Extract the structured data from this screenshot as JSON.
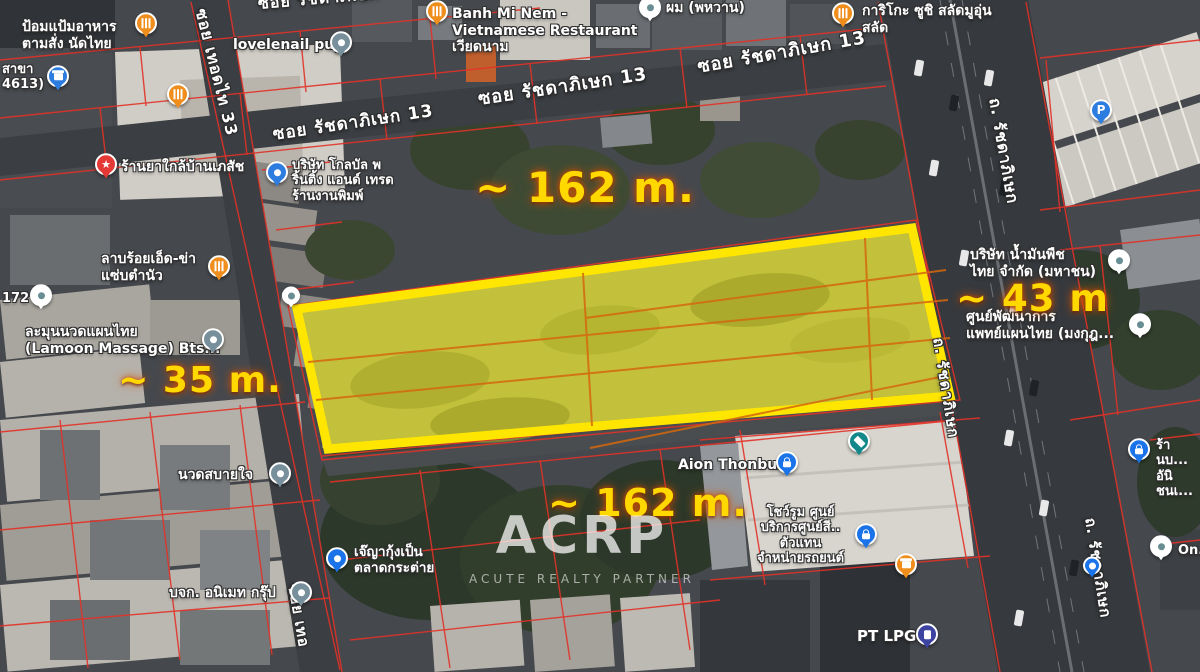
{
  "map": {
    "dimensions": {
      "top": "~ 162 m.",
      "bottom": "~ 162 m.",
      "left": "~ 35 m.",
      "right": "~ 43 m",
      "color": "#ffd800"
    },
    "watermark": {
      "logo": "ACRP",
      "tagline": "ACUTE REALTY PARTNER"
    },
    "streets": [
      {
        "id": "soi-ratchadaphisek-top-partial",
        "label": "ซอย รัชดาภิเษก"
      },
      {
        "id": "soi-ratchadaphisek-13-west",
        "label": "ซอย รัชดาภิเษก 13"
      },
      {
        "id": "soi-ratchadaphisek-13-mid",
        "label": "ซอย รัชดาภิเษก 13"
      },
      {
        "id": "soi-ratchadaphisek-13-east",
        "label": "ซอย รัชดาภิเษก 13"
      },
      {
        "id": "soi-thoet-thai-33",
        "label": "ซอย เทอดไท 33"
      },
      {
        "id": "soi-thoet-thai-bottom-partial",
        "label": "ซอย เทอ"
      },
      {
        "id": "thanon-ratchadaphisek-upper",
        "label": "ถ. รัชดาภิเษก"
      },
      {
        "id": "thanon-ratchadaphisek-mid",
        "label": "ถ. รัชดาภิเษก"
      },
      {
        "id": "thanon-ratchadaphisek-lower",
        "label": "ถ. รัชดาภิเษก"
      }
    ],
    "pois": [
      {
        "id": "pompam-restaurant",
        "label": "ป้อมแป้มอาหาร\nตามสั่ง นัดไทย"
      },
      {
        "id": "branch-4613",
        "label": "สาขา\n4613)"
      },
      {
        "id": "marker-172",
        "label": "172"
      },
      {
        "id": "pharmacy",
        "label": "ร้านยาใกล้บ้านเภสัช"
      },
      {
        "id": "global-printing",
        "label": "บริษัท โกลบัล พ\nริ้นติ้ง แอนด์ เทรด\nร้านงานพิมพ์"
      },
      {
        "id": "lovelenail",
        "label": "lovelenail puy"
      },
      {
        "id": "banh-mi-nem",
        "label": "Banh Mi Nem -\nVietnamese Restaurant\nเวียดนาม"
      },
      {
        "id": "hair-salon",
        "label": "ผม (พหวาน)"
      },
      {
        "id": "kariko-sushi",
        "label": "การิโกะ ซูชิ สลัดมูอุ่น\nสลัด"
      },
      {
        "id": "lab-roi-et",
        "label": "ลาบร้อยเอ็ด-ข่า\nแซ่บตำนัว"
      },
      {
        "id": "lamoon-massage",
        "label": "ละมุนนวดแผนไทย\n(Lamoon Massage) Bts..."
      },
      {
        "id": "nuat-sabai-jai",
        "label": "นวดสบายใจ"
      },
      {
        "id": "animate-group",
        "label": "บจก. อนิเมท กรุ๊ป"
      },
      {
        "id": "je-ya-kung",
        "label": "เจ๊ญากุ้งเป็น\nตลาดกระต่าย"
      },
      {
        "id": "aion-thonburi",
        "label": "Aion Thonburi"
      },
      {
        "id": "car-showroom",
        "label": "โชว์รูม ศูนย์\nบริการศูนย์สี..\nตัวแทน\nจำหน่ายรถยนต์"
      },
      {
        "id": "pt-lpg",
        "label": "PT LPG"
      },
      {
        "id": "thai-vegetable-oil",
        "label": "บริษัท น้ำมันพืช\nไทย จำกัด (มหาชน)"
      },
      {
        "id": "thai-medicine-center",
        "label": "ศูนย์พัฒนาการ\nแพทย์แผนไทย (มงกุฎ..."
      },
      {
        "id": "shop-right-edge",
        "label": "ร้านบ...\nอันิชนเ..."
      },
      {
        "id": "on-marker",
        "label": "On..."
      }
    ],
    "icons": {
      "restaurant": "fork-knife glyph, orange pin",
      "lock": "padlock glyph, blue pin",
      "star": "★ glyph, red pin",
      "parking": "P letter, blue pin",
      "graduation": "mortarboard glyph, teal pin",
      "gas": "pump glyph, indigo pin",
      "store": "storefront glyph",
      "generic": "white dot"
    },
    "colors": {
      "plot_outline": "#ffe600",
      "plot_fill": "rgba(247,235,26,0.38)",
      "cadastral_line": "#e23228",
      "parcel_divider": "#d4680e",
      "dimension_text": "#ffd800"
    }
  }
}
